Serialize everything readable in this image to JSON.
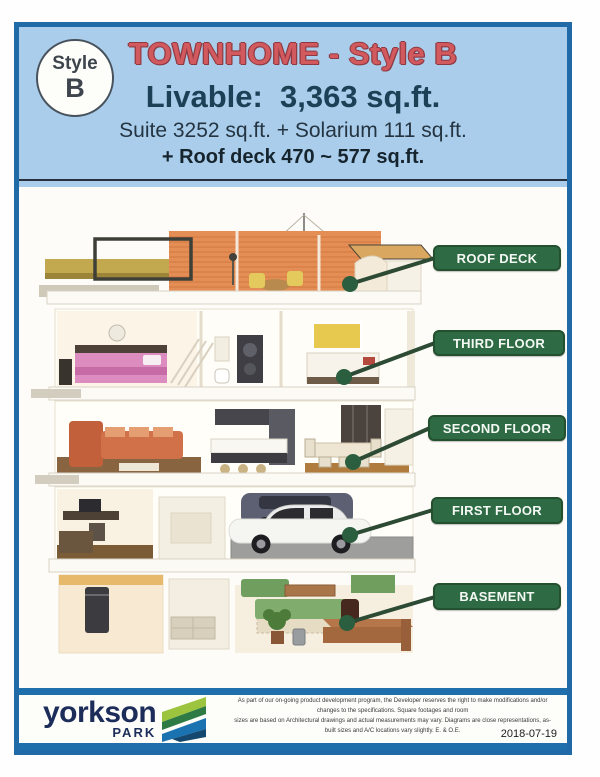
{
  "badge": {
    "line1": "Style",
    "line2": "B"
  },
  "header": {
    "title": "TOWNHOME - Style B",
    "livable": "Livable:  3,363 sq.ft.",
    "suite_line": "Suite 3252 sq.ft. + Solarium 111 sq.ft.",
    "roof_line": "+ Roof deck 470 ~ 577 sq.ft."
  },
  "floors": [
    {
      "label": "ROOF DECK"
    },
    {
      "label": "THIRD FLOOR"
    },
    {
      "label": "SECOND FLOOR"
    },
    {
      "label": "FIRST FLOOR"
    },
    {
      "label": "BASEMENT"
    }
  ],
  "footer": {
    "brand": {
      "name": "yorkson",
      "sub": "PARK"
    },
    "disclaimer_line1": "As part of our on-going product development program, the Developer reserves the right to make modifications and/or changes to the specifications. Square footages and room",
    "disclaimer_line2": "sizes are based on Architectural drawings and actual measurements may vary. Diagrams are close representations, as-built sizes and A/C locations vary slightly. E. & O.E.",
    "date": "2018-07-19"
  },
  "colors": {
    "frame_blue": "#1f6aa7",
    "header_bg": "#a9cdea",
    "title_red": "#d2595d",
    "text_navy": "#1c4156",
    "label_green": "#2e6b45",
    "callout_green": "#2a5e3e",
    "logo_navy": "#1c2d5a",
    "logo_light_green": "#9cc43e",
    "logo_dark_green": "#2e7a44",
    "logo_blue": "#1b72b0"
  }
}
